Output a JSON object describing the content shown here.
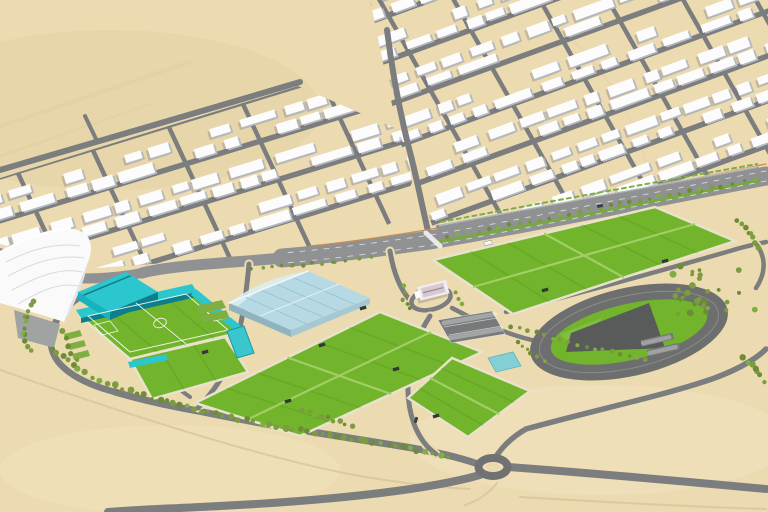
{
  "scene": {
    "description": "Aerial 3D rendering of a desert sports-complex masterplan beside a white residential district",
    "canvas": {
      "width": 768,
      "height": 512
    },
    "colors": {
      "sand": "#ecdbb0",
      "sandLight": "#f3e7c6",
      "sandShade": "#e0cda0",
      "dirtPath": "#d8c49b",
      "roadMain": "#8f9193",
      "roadMinor": "#7b7d7e",
      "roadDark": "#6f7172",
      "medianGreen": "#79a843",
      "hedgeGreen": "#7fae43",
      "treeGreen": "#7d9c3f",
      "treeDark": "#6d8c36",
      "wallLine": "#c98d52",
      "laneDash": "rgba(255,255,255,0.65)",
      "crosswalk": "rgba(255,255,255,0.8)",
      "buildingTop": "#fcfcfd",
      "buildingSide": "#b5b8bf",
      "buildingShadow": "rgba(108,112,124,0.32)",
      "grass": "#72b42b",
      "mowLine": "rgba(20,80,0,0.10)",
      "fieldDivider": "#a2ce66",
      "fieldRim": "#e9e2cc",
      "pitchLine": "rgba(255,255,255,0.85)",
      "teal": "#2cc7ce",
      "tealMid": "#17b2bd",
      "tealDark": "#0d7f8c",
      "aquaRoof": "#b7d9e3",
      "aquaLight": "#d9edf2",
      "aquaFrame": "#93c2cf",
      "aquaWall": "#8fb4c0",
      "aquaSide": "#a5c8d2",
      "poolTeal": "#39c6cd",
      "stripTeal": "#84cfd4",
      "trackRing": "#6d6f6e",
      "trackLane": "rgba(240,240,240,0.22)",
      "grandstand": "#585b5a",
      "infieldLight": "#82bd41",
      "parking": "#77797a",
      "parkingLine": "rgba(255,255,255,0.6)",
      "domeWhite": "#fafafa",
      "domeRib": "#d9dadf",
      "domeSide": "#e2e2e8",
      "plaza": "#9fa3a1",
      "clubWhite": "#efedf2",
      "clubRoof": "#d9c9cf",
      "shelter": "#2f3a34",
      "carWhite": "#f5f5f5",
      "carDark": "#3a3f42"
    },
    "map_features": [
      {
        "id": "residential-district",
        "label": "residential blocks"
      },
      {
        "id": "boulevard",
        "label": "main boulevard"
      },
      {
        "id": "dome-arena",
        "label": "white dome arena"
      },
      {
        "id": "stadium",
        "label": "teal stadium"
      },
      {
        "id": "aquatic-centre",
        "label": "glass aquatic centre"
      },
      {
        "id": "training-fields",
        "label": "training pitches"
      },
      {
        "id": "athletics-track",
        "label": "athletics track"
      },
      {
        "id": "parking-lot",
        "label": "parking"
      },
      {
        "id": "roundabout",
        "label": "roundabout"
      }
    ]
  },
  "generation": {
    "residential_zones": [
      {
        "id": "residential-top-left",
        "seed": 11,
        "angle": -17,
        "origin": [
          -30,
          186
        ],
        "rows": 10,
        "rowSpacing": 14,
        "streetEvery": 3,
        "uLen": 500,
        "crossStart": 45,
        "crossEvery": 78,
        "lean": 0.2,
        "clip": [
          [
            0,
            178
          ],
          [
            298,
            86
          ],
          [
            404,
            132
          ],
          [
            412,
            182
          ],
          [
            398,
            220
          ],
          [
            330,
            250
          ],
          [
            240,
            260
          ],
          [
            150,
            264
          ],
          [
            98,
            268
          ],
          [
            40,
            256
          ],
          [
            0,
            244
          ]
        ]
      },
      {
        "id": "residential-top-right",
        "seed": 23,
        "angle": -20,
        "origin": [
          346,
          -14
        ],
        "rows": 21,
        "rowSpacing": 14,
        "streetEvery": 3,
        "uLen": 500,
        "crossStart": 25,
        "crossEvery": 66,
        "lean": 0.2,
        "clip": [
          [
            370,
            0
          ],
          [
            768,
            0
          ],
          [
            768,
            170
          ],
          [
            700,
            184
          ],
          [
            560,
            208
          ],
          [
            434,
            230
          ],
          [
            400,
            142
          ],
          [
            382,
            58
          ]
        ]
      }
    ],
    "fields": [
      {
        "id": "field-quad",
        "poly": [
          [
            433,
            260
          ],
          [
            655,
            207
          ],
          [
            735,
            241
          ],
          [
            513,
            314
          ]
        ],
        "stripes": 6,
        "divide": "quad"
      },
      {
        "id": "field-central",
        "poly": [
          [
            195,
            403
          ],
          [
            380,
            312
          ],
          [
            482,
            352
          ],
          [
            300,
            436
          ]
        ],
        "stripes": 6,
        "divide": "quad"
      },
      {
        "id": "field-right",
        "poly": [
          [
            408,
            398
          ],
          [
            452,
            358
          ],
          [
            530,
            391
          ],
          [
            468,
            437
          ]
        ],
        "stripes": 4,
        "divide": "half"
      },
      {
        "id": "field-stadium-annex",
        "poly": [
          [
            130,
            359
          ],
          [
            225,
            337
          ],
          [
            248,
            372
          ],
          [
            152,
            399
          ]
        ],
        "stripes": 3,
        "divide": "none"
      },
      {
        "id": "stadium-pitch",
        "poly": [
          [
            80,
            316
          ],
          [
            192,
            290
          ],
          [
            242,
            332
          ],
          [
            130,
            359
          ]
        ],
        "stripes": 4,
        "divide": "none"
      }
    ],
    "tree_lines": [
      {
        "pts": [
          [
            52,
            348
          ],
          [
            78,
            370
          ],
          [
            115,
            386
          ],
          [
            160,
            400
          ],
          [
            215,
            414
          ],
          [
            270,
            425
          ],
          [
            330,
            436
          ],
          [
            395,
            446
          ],
          [
            448,
            457
          ]
        ],
        "spacing": 7.5,
        "rmin": 1.8,
        "rmax": 3.4
      },
      {
        "pts": [
          [
            447,
            237
          ],
          [
            530,
            222
          ],
          [
            620,
            204
          ],
          [
            700,
            190
          ],
          [
            754,
            180
          ]
        ],
        "spacing": 10.5,
        "rmin": 1.5,
        "rmax": 2.4
      },
      {
        "pts": [
          [
            512,
            326
          ],
          [
            560,
            340
          ],
          [
            612,
            352
          ],
          [
            646,
            359
          ]
        ],
        "spacing": 8.5,
        "rmin": 1.7,
        "rmax": 2.6
      },
      {
        "pts": [
          [
            737,
            220
          ],
          [
            750,
            232
          ],
          [
            758,
            247
          ]
        ],
        "spacing": 6,
        "rmin": 2,
        "rmax": 3
      },
      {
        "pts": [
          [
            742,
            357
          ],
          [
            757,
            370
          ],
          [
            764,
            382
          ]
        ],
        "spacing": 6,
        "rmin": 2,
        "rmax": 3.2
      },
      {
        "pts": [
          [
            518,
            343
          ],
          [
            531,
            353
          ],
          [
            544,
            361
          ]
        ],
        "spacing": 6.5,
        "rmin": 1.6,
        "rmax": 2.4
      },
      {
        "pts": [
          [
            303,
            410
          ],
          [
            328,
            418
          ],
          [
            352,
            425
          ]
        ],
        "spacing": 7,
        "rmin": 1.8,
        "rmax": 2.8
      },
      {
        "pts": [
          [
            252,
            268
          ],
          [
            292,
            265
          ],
          [
            334,
            262
          ],
          [
            372,
            258
          ]
        ],
        "spacing": 11,
        "rmin": 1.6,
        "rmax": 2.2
      },
      {
        "pts": [
          [
            405,
            287
          ],
          [
            402,
            299
          ],
          [
            410,
            309
          ]
        ],
        "spacing": 7,
        "rmin": 1.8,
        "rmax": 2.6
      },
      {
        "pts": [
          [
            455,
            293
          ],
          [
            463,
            303
          ]
        ],
        "spacing": 7,
        "rmin": 1.8,
        "rmax": 2.4
      },
      {
        "pts": [
          [
            34,
            300
          ],
          [
            26,
            316
          ],
          [
            24,
            334
          ],
          [
            30,
            351
          ]
        ],
        "spacing": 7,
        "rmin": 1.8,
        "rmax": 2.8
      },
      {
        "pts": [
          [
            62,
            332
          ],
          [
            68,
            346
          ],
          [
            76,
            359
          ]
        ],
        "spacing": 6.5,
        "rmin": 2,
        "rmax": 3
      }
    ],
    "tree_clusters": [
      {
        "cx": 713,
        "cy": 290,
        "rx": 42,
        "ry": 24,
        "n": 26,
        "rmin": 1.8,
        "rmax": 3.6
      },
      {
        "cx": 694,
        "cy": 306,
        "rx": 16,
        "ry": 9,
        "n": 8,
        "rmin": 1.5,
        "rmax": 2.6
      }
    ],
    "shelters": [
      [
        322,
        345,
        -17
      ],
      [
        288,
        401,
        -17
      ],
      [
        396,
        369,
        -17
      ],
      [
        436,
        416,
        -17
      ],
      [
        363,
        308,
        -17
      ],
      [
        545,
        290,
        -14
      ],
      [
        665,
        261,
        -14
      ],
      [
        205,
        352,
        -17
      ]
    ],
    "vehicles": {
      "white": [
        [
          488,
          243,
          -13
        ]
      ],
      "dark": [
        [
          600,
          206,
          -11
        ],
        [
          416,
          420,
          -72
        ]
      ]
    },
    "veg_seed": 5
  }
}
